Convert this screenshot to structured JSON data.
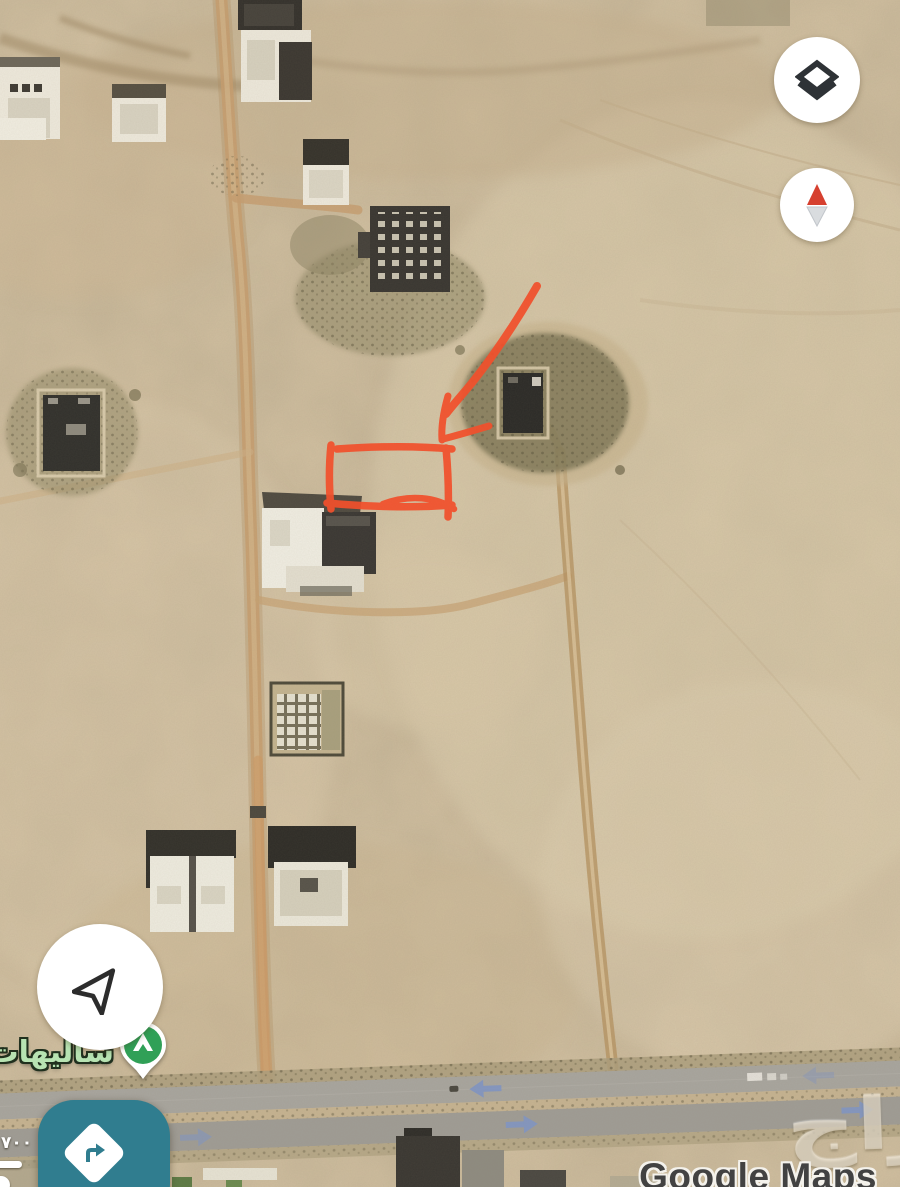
{
  "map": {
    "place_label": "ساليهات",
    "attribution": "Google Maps",
    "watermark": "حراج",
    "scale_value": "٧٠٠"
  },
  "annotation": {
    "shape": "hand-drawn rectangle with curved arrow pointing at empty plot",
    "color": "#F1502C"
  },
  "controls": {
    "layers_button_icon": "layers-icon",
    "compass_button_icon": "compass-needle-icon",
    "my_location_button_icon": "navigation-arrow-icon",
    "directions_button_icon": "turn-right-icon",
    "poi_pin_icon": "campground-pin-icon"
  },
  "highway": {
    "arrow_color": "#8296C3",
    "upper_lane_direction": "left",
    "lower_lane_direction": "right"
  },
  "colors": {
    "sand": "#D2C09F",
    "annotation_red": "#F1502C",
    "directions_button_teal": "#307D8F",
    "pin_green": "#30A057",
    "place_label_green": "#B7E3B2",
    "compass_north_red": "#D6402F"
  }
}
